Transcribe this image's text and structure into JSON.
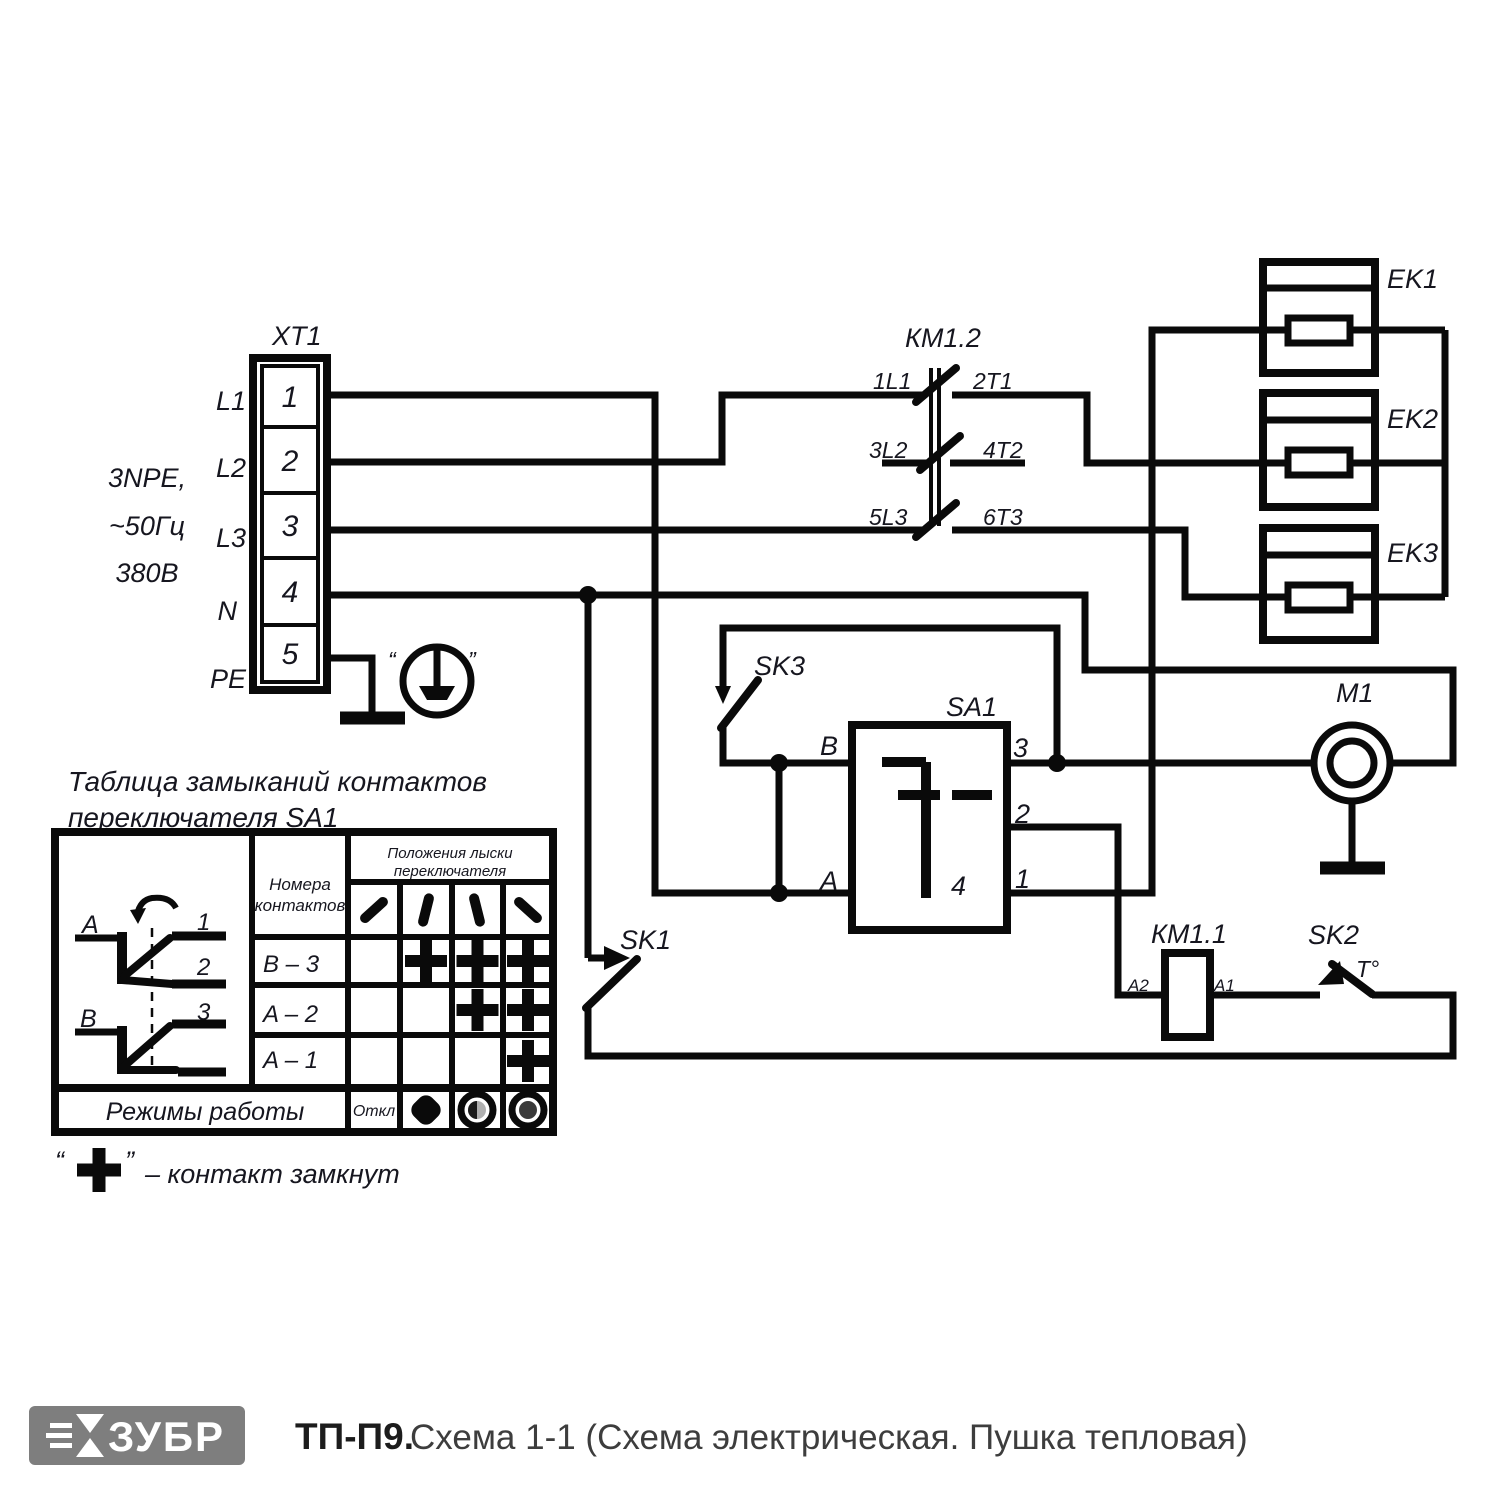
{
  "schematic": {
    "xt1": {
      "label": "XT1",
      "supply_lines": [
        "3NPE,",
        "~50Гц",
        "380В"
      ],
      "wire_labels": [
        "L1",
        "L2",
        "L3",
        "N",
        "PE"
      ],
      "terminals": [
        "1",
        "2",
        "3",
        "4",
        "5"
      ],
      "earth_quote_left": "“",
      "earth_quote_right": "”"
    },
    "km12": {
      "label": "КМ1.2",
      "c1_in": "1L1",
      "c1_out": "2T1",
      "c2_in": "3L2",
      "c2_out": "4T2",
      "c3_in": "5L3",
      "c3_out": "6T3"
    },
    "km11": {
      "label": "КМ1.1",
      "a2": "A2",
      "a1": "A1"
    },
    "heaters": [
      {
        "label": "EK1"
      },
      {
        "label": "EK2"
      },
      {
        "label": "EK3"
      }
    ],
    "motor": {
      "label": "M1"
    },
    "sa1": {
      "label": "SA1",
      "b": "B",
      "a": "A",
      "t3": "3",
      "t2": "2",
      "t1": "1",
      "t4": "4"
    },
    "sk1": {
      "label": "SK1"
    },
    "sk2": {
      "label": "SK2",
      "temp": "T°"
    },
    "sk3": {
      "label": "SK3"
    }
  },
  "table": {
    "title_line1": "Таблица замыканий контактов",
    "title_line2": "переключателя SA1",
    "diagram": {
      "a": "A",
      "b": "B",
      "n1": "1",
      "n2": "2",
      "n3": "3"
    },
    "contacts_header": [
      "Номера",
      "контактов"
    ],
    "positions_header": [
      "Положения лыски",
      "переключателя"
    ],
    "rows": [
      {
        "contacts": "B – 3",
        "closed": [
          2,
          3,
          4
        ]
      },
      {
        "contacts": "A – 2",
        "closed": [
          3,
          4
        ]
      },
      {
        "contacts": "A – 1",
        "closed": [
          4
        ]
      }
    ],
    "modes_label": "Режимы работы",
    "off_label": "Откл",
    "note_quote_left": "“",
    "note_quote_right": "”",
    "note": "– контакт замкнут"
  },
  "footer": {
    "brand": "ЗУБР",
    "model": "ТП-П9.",
    "caption": "Схема 1-1 (Схема электрическая. Пушка тепловая)"
  }
}
